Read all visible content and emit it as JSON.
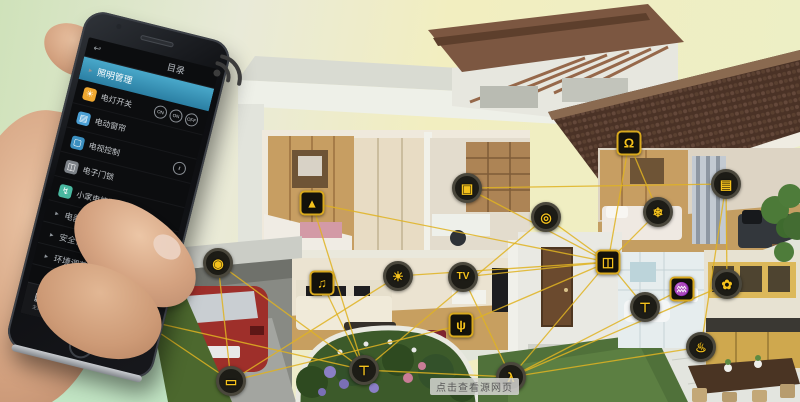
{
  "scene": {
    "watermark": "点击查看源网页",
    "connection_color": "#e0b322",
    "background_colors": [
      "#cfe2ba",
      "#f2eec0",
      "#ecefc6"
    ]
  },
  "phone": {
    "title": "目录",
    "back_icon": "↩",
    "menu": {
      "selected_marker": "▸",
      "selected": "照明管理",
      "rows": [
        {
          "label": "电灯开关",
          "glyph": "☀",
          "icon_color": "#f0a830",
          "controls": [
            "ON",
            "ON",
            "OFF"
          ]
        },
        {
          "label": "电动窗帘",
          "glyph": "▤",
          "icon_color": "#4a9fd4",
          "controls": []
        },
        {
          "label": "电视控制",
          "glyph": "▢",
          "icon_color": "#3b8fc0",
          "controls": [
            "‖"
          ]
        },
        {
          "label": "电子门锁",
          "glyph": "◫",
          "icon_color": "#7d8288",
          "controls": []
        },
        {
          "label": "小家电控制",
          "glyph": "↯",
          "icon_color": "#49b8a0",
          "controls": []
        }
      ],
      "sections": [
        "电器控制",
        "安全保护",
        "环境调节"
      ]
    },
    "nav": [
      {
        "label": "主页",
        "icon": "grid-icon",
        "glyph": "▦"
      },
      {
        "label": "设备",
        "icon": "square-icon",
        "glyph": "▢"
      },
      {
        "label": "控制",
        "icon": "sync-icon",
        "glyph": "↻",
        "active": true
      },
      {
        "label": "场景",
        "icon": "dark-circle-icon",
        "glyph": "◉"
      },
      {
        "label": "更多",
        "icon": "windows-flag-icon",
        "glyph": "",
        "flag_colors": [
          "#e64a3c",
          "#7ac143",
          "#2e9fd0",
          "#f2b630"
        ]
      }
    ]
  },
  "house": {
    "sensors": [
      {
        "id": "cctv",
        "name": "cctv-camera-icon",
        "shape": "circle",
        "glyph": "◉",
        "x": 218,
        "y": 263
      },
      {
        "id": "socket",
        "name": "power-socket-icon",
        "shape": "square",
        "glyph": "↯",
        "x": 139,
        "y": 319
      },
      {
        "id": "garage",
        "name": "garage-door-icon",
        "shape": "circle",
        "glyph": "▭",
        "x": 231,
        "y": 381
      },
      {
        "id": "lamp",
        "name": "table-lamp-icon",
        "shape": "square",
        "glyph": "▴",
        "x": 312,
        "y": 203
      },
      {
        "id": "safe",
        "name": "safe-box-icon",
        "shape": "circle",
        "glyph": "▣",
        "x": 467,
        "y": 188
      },
      {
        "id": "audio",
        "name": "audio-player-icon",
        "shape": "square",
        "glyph": "♫",
        "x": 322,
        "y": 283
      },
      {
        "id": "light",
        "name": "ceiling-light-icon",
        "shape": "circle",
        "glyph": "☀",
        "x": 398,
        "y": 276
      },
      {
        "id": "tv",
        "name": "tv-icon",
        "shape": "circle",
        "glyph": "TV",
        "x": 463,
        "y": 277
      },
      {
        "id": "router",
        "name": "wifi-router-icon",
        "shape": "square",
        "glyph": "ψ",
        "x": 461,
        "y": 325
      },
      {
        "id": "fountain",
        "name": "water-fountain-icon",
        "shape": "circle",
        "glyph": "⊤",
        "x": 364,
        "y": 370
      },
      {
        "id": "motion",
        "name": "motion-sensor-icon",
        "shape": "circle",
        "glyph": "λ",
        "x": 511,
        "y": 377
      },
      {
        "id": "stereo",
        "name": "stereo-icon",
        "shape": "circle",
        "glyph": "◎",
        "x": 546,
        "y": 217
      },
      {
        "id": "lock",
        "name": "door-lock-icon",
        "shape": "square",
        "glyph": "◫",
        "x": 608,
        "y": 262
      },
      {
        "id": "bell",
        "name": "doorbell-icon",
        "shape": "square",
        "glyph": "Ω",
        "x": 629,
        "y": 143
      },
      {
        "id": "ac",
        "name": "air-conditioner-icon",
        "shape": "circle",
        "glyph": "❄",
        "x": 658,
        "y": 212
      },
      {
        "id": "curtain",
        "name": "curtain-icon",
        "shape": "circle",
        "glyph": "▤",
        "x": 726,
        "y": 184
      },
      {
        "id": "faucet",
        "name": "bathroom-faucet-icon",
        "shape": "circle",
        "glyph": "⊤",
        "x": 645,
        "y": 307
      },
      {
        "id": "heater",
        "name": "water-heater-icon",
        "shape": "square",
        "glyph": "♒",
        "x": 682,
        "y": 289
      },
      {
        "id": "fan",
        "name": "exhaust-fan-icon",
        "shape": "circle",
        "glyph": "✿",
        "x": 727,
        "y": 284
      },
      {
        "id": "stove",
        "name": "stove-icon",
        "shape": "circle",
        "glyph": "♨",
        "x": 701,
        "y": 347
      }
    ],
    "links": [
      [
        "socket",
        "garage"
      ],
      [
        "cctv",
        "garage"
      ],
      [
        "cctv",
        "fountain"
      ],
      [
        "garage",
        "light"
      ],
      [
        "garage",
        "router"
      ],
      [
        "lamp",
        "fountain"
      ],
      [
        "lamp",
        "lock"
      ],
      [
        "audio",
        "fountain"
      ],
      [
        "light",
        "lock"
      ],
      [
        "safe",
        "lock"
      ],
      [
        "safe",
        "curtain"
      ],
      [
        "tv",
        "lock"
      ],
      [
        "tv",
        "motion"
      ],
      [
        "router",
        "lock"
      ],
      [
        "fountain",
        "motion"
      ],
      [
        "motion",
        "lock"
      ],
      [
        "bell",
        "lock"
      ],
      [
        "bell",
        "ac"
      ],
      [
        "stereo",
        "lock"
      ],
      [
        "ac",
        "lock"
      ],
      [
        "curtain",
        "stove"
      ],
      [
        "faucet",
        "lock"
      ],
      [
        "heater",
        "motion"
      ],
      [
        "fan",
        "motion"
      ],
      [
        "stove",
        "motion"
      ],
      [
        "fan",
        "curtain"
      ],
      [
        "stereo",
        "fountain"
      ],
      [
        "socket",
        "fountain"
      ]
    ]
  }
}
